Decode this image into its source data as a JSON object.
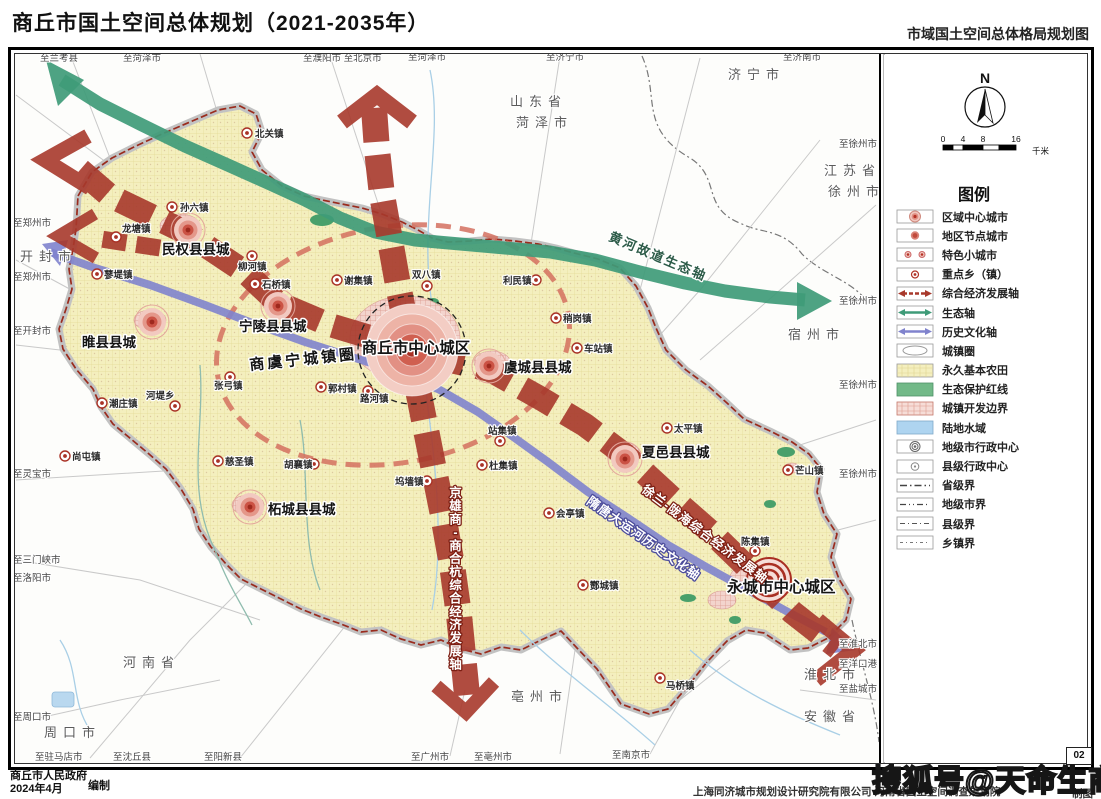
{
  "header": {
    "title": "商丘市国土空间总体规划（2021-2035年）",
    "map_title": "市域国土空间总体格局规划图"
  },
  "compass": {
    "north_label": "N"
  },
  "scalebar": {
    "ticks": [
      "0",
      "4",
      "8",
      "16"
    ],
    "unit": "千米"
  },
  "legend": {
    "title": "图例",
    "items": [
      {
        "label": "区域中心城市",
        "type": "city-regional"
      },
      {
        "label": "地区节点城市",
        "type": "city-node"
      },
      {
        "label": "特色小城市",
        "type": "city-small"
      },
      {
        "label": "重点乡（镇）",
        "type": "town-key"
      },
      {
        "label": "综合经济发展轴",
        "type": "axis-economic"
      },
      {
        "label": "生态轴",
        "type": "axis-eco"
      },
      {
        "label": "历史文化轴",
        "type": "axis-history"
      },
      {
        "label": "城镇圈",
        "type": "town-circle"
      },
      {
        "label": "永久基本农田",
        "type": "farmland"
      },
      {
        "label": "生态保护红线",
        "type": "eco-redline"
      },
      {
        "label": "城镇开发边界",
        "type": "urban-boundary"
      },
      {
        "label": "陆地水域",
        "type": "water"
      },
      {
        "label": "地级市行政中心",
        "type": "admin-city"
      },
      {
        "label": "县级行政中心",
        "type": "admin-county"
      },
      {
        "label": "省级界",
        "type": "border-province"
      },
      {
        "label": "地级市界",
        "type": "border-city"
      },
      {
        "label": "县级界",
        "type": "border-county"
      },
      {
        "label": "乡镇界",
        "type": "border-town"
      }
    ]
  },
  "map": {
    "cities": [
      {
        "name": "商丘市中心城区",
        "x": 416,
        "y": 353,
        "sx": 412,
        "sy": 350,
        "size": "major",
        "anchor": "middle"
      },
      {
        "name": "民权县县城",
        "x": 162,
        "y": 254,
        "sx": 188,
        "sy": 230,
        "size": "county"
      },
      {
        "name": "宁陵县县城",
        "x": 239,
        "y": 331,
        "sx": 278,
        "sy": 306,
        "size": "county"
      },
      {
        "name": "睢县县城",
        "x": 82,
        "y": 347,
        "sx": 152,
        "sy": 322,
        "size": "county"
      },
      {
        "name": "柘城县县城",
        "x": 268,
        "y": 514,
        "sx": 250,
        "sy": 507,
        "size": "county"
      },
      {
        "name": "虞城县县城",
        "x": 504,
        "y": 372,
        "sx": 489,
        "sy": 366,
        "size": "county"
      },
      {
        "name": "夏邑县县城",
        "x": 642,
        "y": 457,
        "sx": 625,
        "sy": 459,
        "size": "county"
      },
      {
        "name": "永城市中心城区",
        "x": 727,
        "y": 592,
        "sx": 769,
        "sy": 580,
        "size": "node"
      }
    ],
    "towns": [
      {
        "name": "北关镇",
        "dx": 247,
        "dy": 133,
        "lx": 255,
        "ly": 137
      },
      {
        "name": "孙六镇",
        "dx": 172,
        "dy": 207,
        "lx": 180,
        "ly": 211
      },
      {
        "name": "龙塘镇",
        "dx": 116,
        "dy": 237,
        "lx": 122,
        "ly": 232
      },
      {
        "name": "蓼堤镇",
        "dx": 97,
        "dy": 274,
        "lx": 104,
        "ly": 278
      },
      {
        "name": "柳河镇",
        "dx": 252,
        "dy": 256,
        "lx": 238,
        "ly": 270
      },
      {
        "name": "石桥镇",
        "dx": 255,
        "dy": 284,
        "lx": 262,
        "ly": 288
      },
      {
        "name": "谢集镇",
        "dx": 337,
        "dy": 280,
        "lx": 344,
        "ly": 284
      },
      {
        "name": "双八镇",
        "dx": 427,
        "dy": 286,
        "lx": 412,
        "ly": 278
      },
      {
        "name": "利民镇",
        "dx": 536,
        "dy": 280,
        "lx": 503,
        "ly": 284
      },
      {
        "name": "稍岗镇",
        "dx": 556,
        "dy": 318,
        "lx": 563,
        "ly": 322
      },
      {
        "name": "车站镇",
        "dx": 577,
        "dy": 348,
        "lx": 584,
        "ly": 352
      },
      {
        "name": "太平镇",
        "dx": 667,
        "dy": 428,
        "lx": 674,
        "ly": 432
      },
      {
        "name": "芒山镇",
        "dx": 788,
        "dy": 470,
        "lx": 795,
        "ly": 474
      },
      {
        "name": "陈集镇",
        "dx": 755,
        "dy": 551,
        "lx": 741,
        "ly": 545
      },
      {
        "name": "会亭镇",
        "dx": 549,
        "dy": 513,
        "lx": 556,
        "ly": 517
      },
      {
        "name": "酂城镇",
        "dx": 583,
        "dy": 585,
        "lx": 590,
        "ly": 589
      },
      {
        "name": "马桥镇",
        "dx": 660,
        "dy": 678,
        "lx": 666,
        "ly": 689
      },
      {
        "name": "站集镇",
        "dx": 500,
        "dy": 441,
        "lx": 488,
        "ly": 434
      },
      {
        "name": "杜集镇",
        "dx": 482,
        "dy": 465,
        "lx": 489,
        "ly": 469
      },
      {
        "name": "坞墙镇",
        "dx": 427,
        "dy": 481,
        "lx": 395,
        "ly": 485
      },
      {
        "name": "胡襄镇",
        "dx": 314,
        "dy": 464,
        "lx": 284,
        "ly": 468
      },
      {
        "name": "慈圣镇",
        "dx": 218,
        "dy": 461,
        "lx": 225,
        "ly": 465
      },
      {
        "name": "张弓镇",
        "dx": 230,
        "dy": 377,
        "lx": 214,
        "ly": 389
      },
      {
        "name": "河堤乡",
        "dx": 175,
        "dy": 406,
        "lx": 146,
        "ly": 399
      },
      {
        "name": "潮庄镇",
        "dx": 102,
        "dy": 403,
        "lx": 109,
        "ly": 407
      },
      {
        "name": "尚屯镇",
        "dx": 65,
        "dy": 456,
        "lx": 72,
        "ly": 460
      },
      {
        "name": "郭村镇",
        "dx": 321,
        "dy": 387,
        "lx": 328,
        "ly": 392
      },
      {
        "name": "路河镇",
        "dx": 368,
        "dy": 391,
        "lx": 360,
        "ly": 402
      }
    ],
    "regions": [
      {
        "name": "山东省",
        "x": 510,
        "y": 106
      },
      {
        "name": "菏泽市",
        "x": 516,
        "y": 127
      },
      {
        "name": "济宁市",
        "x": 728,
        "y": 79
      },
      {
        "name": "江苏省",
        "x": 824,
        "y": 175
      },
      {
        "name": "徐州市",
        "x": 828,
        "y": 196
      },
      {
        "name": "开封市",
        "x": 20,
        "y": 261
      },
      {
        "name": "宿州市",
        "x": 788,
        "y": 339
      },
      {
        "name": "河南省",
        "x": 123,
        "y": 667
      },
      {
        "name": "周口市",
        "x": 44,
        "y": 737
      },
      {
        "name": "亳州市",
        "x": 511,
        "y": 701
      },
      {
        "name": "淮北市",
        "x": 804,
        "y": 679
      },
      {
        "name": "安徽省",
        "x": 804,
        "y": 721
      }
    ],
    "edge_labels": [
      {
        "t": "至兰考县",
        "x": 40,
        "y": 61
      },
      {
        "t": "至菏泽市",
        "x": 123,
        "y": 61
      },
      {
        "t": "至濮阳市 至北京市",
        "x": 303,
        "y": 61
      },
      {
        "t": "至菏泽市",
        "x": 408,
        "y": 60
      },
      {
        "t": "至济宁市",
        "x": 546,
        "y": 60
      },
      {
        "t": "至济南市",
        "x": 783,
        "y": 60
      },
      {
        "t": "至郑州市",
        "x": 13,
        "y": 226
      },
      {
        "t": "至郑州市",
        "x": 13,
        "y": 280
      },
      {
        "t": "至开封市",
        "x": 13,
        "y": 334
      },
      {
        "t": "至灵宝市",
        "x": 13,
        "y": 477
      },
      {
        "t": "至三门峡市",
        "x": 13,
        "y": 563
      },
      {
        "t": "至洛阳市",
        "x": 13,
        "y": 581
      },
      {
        "t": "至驻马店市",
        "x": 35,
        "y": 760
      },
      {
        "t": "至沈丘县",
        "x": 113,
        "y": 760
      },
      {
        "t": "至阳新县",
        "x": 204,
        "y": 760
      },
      {
        "t": "至广州市",
        "x": 411,
        "y": 760
      },
      {
        "t": "至亳州市",
        "x": 474,
        "y": 760
      },
      {
        "t": "至南京市",
        "x": 612,
        "y": 758
      },
      {
        "t": "至徐州市",
        "x": 877,
        "y": 147,
        "anchor": "end"
      },
      {
        "t": "至徐州市",
        "x": 877,
        "y": 304,
        "anchor": "end"
      },
      {
        "t": "至徐州市",
        "x": 877,
        "y": 388,
        "anchor": "end"
      },
      {
        "t": "至徐州市",
        "x": 877,
        "y": 477,
        "anchor": "end"
      },
      {
        "t": "至淮北市",
        "x": 877,
        "y": 647,
        "anchor": "end"
      },
      {
        "t": "至洋口港",
        "x": 877,
        "y": 667,
        "anchor": "end"
      },
      {
        "t": "至盐城市",
        "x": 877,
        "y": 692,
        "anchor": "end"
      },
      {
        "t": "至周口市",
        "x": 13,
        "y": 720
      }
    ],
    "axis_labels": [
      {
        "name": "黄河故道生态轴",
        "x": 608,
        "y": 240,
        "rot": 23,
        "style": "eco"
      },
      {
        "name": "商虞宁城镇圈",
        "x": 250,
        "y": 370,
        "rot": -6,
        "style": "circle"
      },
      {
        "name": "京雄商-商合杭综合经济发展轴",
        "x": 456,
        "y": 497,
        "style": "econ-v"
      },
      {
        "name": "徐兰-陇海综合经济发展轴",
        "x": 641,
        "y": 491,
        "rot": 37,
        "style": "econ"
      },
      {
        "name": "隋唐大运河历史文化轴",
        "x": 586,
        "y": 503,
        "rot": 35,
        "style": "hist"
      }
    ]
  },
  "footer": {
    "org": "商丘市人民政府",
    "date": "2024年4月",
    "role": "编制",
    "credit": "上海同济城市规划设计研究院有限公司  河南省国土空间调查规划院",
    "credit_role": "制图",
    "sheet_no": "02"
  },
  "watermark": "搜狐号@天命生商",
  "colors": {
    "axis_economic": "#a8392c",
    "axis_ecology": "#3f9b78",
    "axis_history": "#8083cd",
    "farmland": "#f4efbe",
    "eco_redline": "#72b988",
    "water": "#aed4f0",
    "county_boundary": "#9a2b1d"
  }
}
